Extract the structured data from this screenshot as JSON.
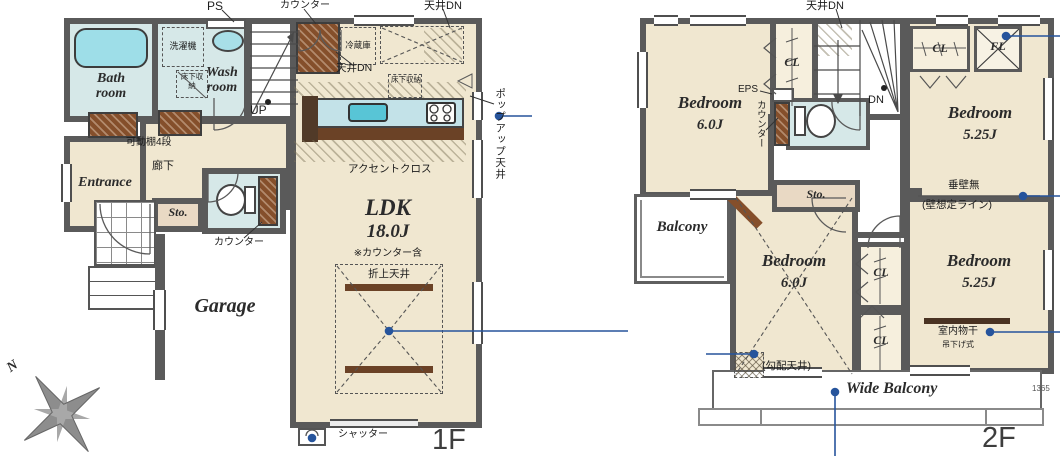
{
  "colors": {
    "wall": "#5a5a5a",
    "floor": "#f0e7d0",
    "wet": "#d6e8e8",
    "tub": "#9edee8",
    "wood": "#854f2b",
    "wood_dark": "#6b4226",
    "storage_floor": "#e9d9c4",
    "closet_floor": "#f6efdd",
    "annotation": "#26549c",
    "text": "#222222"
  },
  "f1": {
    "floor_label": "1F",
    "rooms": {
      "bath": "Bath\nroom",
      "wash": "Wash\nroom",
      "entrance": "Entrance",
      "storage": "Sto.",
      "garage": "Garage",
      "ldk_name": "LDK",
      "ldk_size": "18.0J",
      "ldk_note": "※カウンター含"
    },
    "labels": {
      "ps": "PS",
      "counter_top": "カウンター",
      "ceiling_dn_top": "天井DN",
      "washing_machine": "洗濯機",
      "underfloor_storage_wash": "床下収納",
      "up": "UP",
      "fridge": "冷蔵庫",
      "ceiling_dn_kitchen": "天井DN",
      "underfloor_storage_ldk": "床下収納",
      "popup_ceiling": "ポップアップ天井",
      "accent_cloth": "アクセントクロス",
      "coffered_ceiling": "折上天井",
      "movable_shelf": "可動棚4段",
      "hallway": "廊下",
      "counter_toilet": "カウンター",
      "shutter": "シャッター",
      "compass_north": "N"
    }
  },
  "f2": {
    "floor_label": "2F",
    "rooms": {
      "bedroom1_name": "Bedroom",
      "bedroom1_size": "6.0J",
      "bedroom2_name": "Bedroom",
      "bedroom2_size": "5.25J",
      "bedroom3_name": "Bedroom",
      "bedroom3_size": "6.0J",
      "bedroom4_name": "Bedroom",
      "bedroom4_size": "5.25J",
      "balcony": "Balcony",
      "wide_balcony": "Wide Balcony",
      "storage": "Sto.",
      "closet1": "CL",
      "closet2": "CL",
      "closet3": "CL",
      "closet4": "CL",
      "fixed_light": "FL"
    },
    "labels": {
      "ceiling_dn": "天井DN",
      "eps": "EPS",
      "counter": "カウンター",
      "dn": "DN",
      "no_hanging_wall": "垂壁無",
      "assumed_wall_line": "(壁想定ライン)",
      "sloped_ceiling": "(勾配天井)",
      "indoor_drying": "室内物干",
      "hanging_type": "吊下げ式",
      "dimension": "1365"
    }
  }
}
